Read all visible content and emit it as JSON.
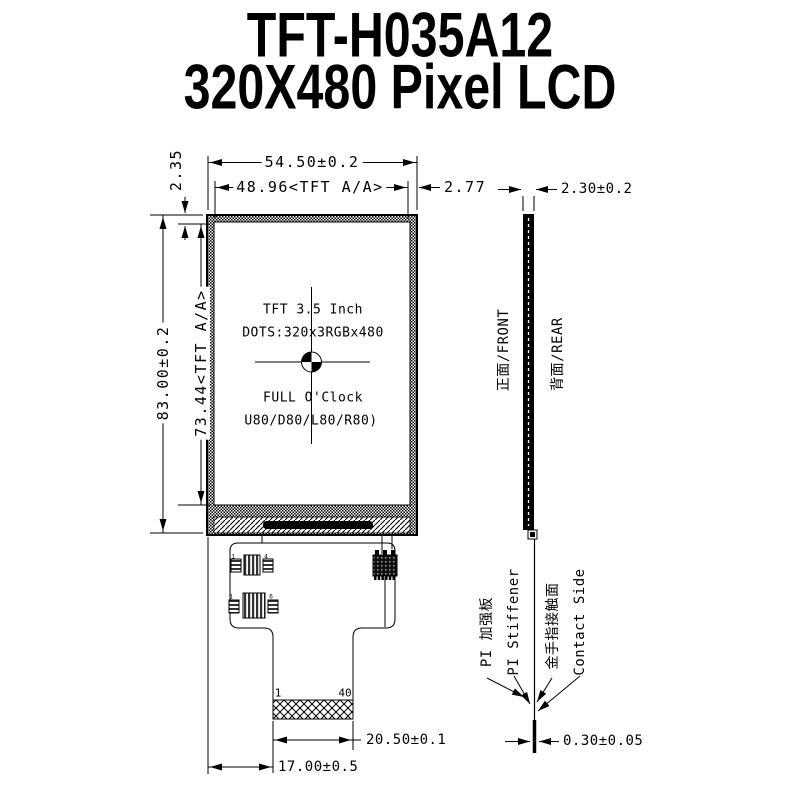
{
  "colors": {
    "ink": "#000000",
    "paper": "#ffffff"
  },
  "title": {
    "line1": "TFT-H035A12",
    "line2": "320X480 Pixel LCD"
  },
  "front_view": {
    "dims": {
      "width": "54.50±0.2",
      "active_width": "48.96<TFT A/A>",
      "right_margin": "2.77",
      "top_margin": "2.35",
      "height": "83.00±0.2",
      "active_height": "73.44<TFT A/A>"
    },
    "screen": {
      "line1": "TFT 3.5 Inch",
      "line2": "DOTS:320x3RGBx480",
      "line3": "FULL O'Clock",
      "line4": "U80/D80/L80/R80)"
    },
    "fpc": {
      "pin_first": "1",
      "pin_last": "40",
      "dim_connector_width": "20.50±0.1",
      "dim_connector_offset": "17.00±0.5",
      "comp_markers": [
        "1",
        "4",
        "1",
        "6"
      ]
    }
  },
  "side_view": {
    "dims": {
      "thickness": "2.30±0.2",
      "fpc_thickness": "0.30±0.05"
    },
    "labels": {
      "front": "正面/FRONT",
      "rear": "背面/REAR",
      "stiffener_cn": "PI 加强板",
      "stiffener_en": "PI Stiffener",
      "contact_cn": "金手指接触面",
      "contact_en": "Contact Side"
    }
  }
}
